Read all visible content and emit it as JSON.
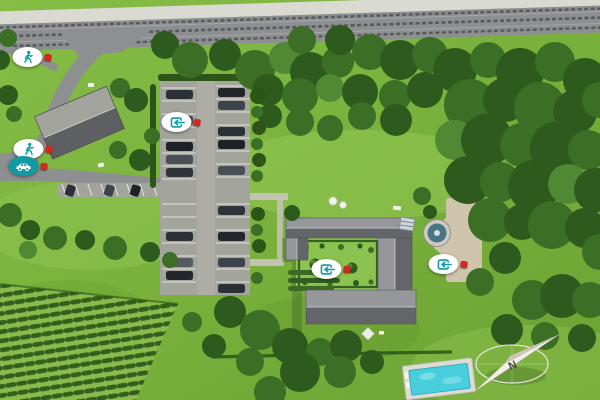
{
  "scene": {
    "type": "3d-aerial-site-plan",
    "compass": {
      "label": "N",
      "pointing": "northeast"
    },
    "colors": {
      "grass": "#79b13c",
      "grass-light": "#93c653",
      "grass-dark": "#5d9129",
      "hedge": "#2c5517",
      "tree-dark": "#2e5a1d",
      "tree-mid": "#3c6e26",
      "tree-light": "#518834",
      "road": "#8d8f90",
      "sidewalk": "#dad9d2",
      "asphalt": "#a3a49c",
      "line": "#e9e9e1",
      "roof-light": "#95979b",
      "roof-dark": "#63656b",
      "path": "#cfc5ac",
      "teal": "#0f9aa4",
      "red": "#cf2a1b",
      "pool": "#49cede",
      "white": "#ffffff"
    },
    "markers": [
      {
        "name": "pedestrian-access-north",
        "kind": "pedestrian",
        "x": 32,
        "y": 57,
        "style": "light",
        "pin": "right"
      },
      {
        "name": "pedestrian-access-west",
        "kind": "pedestrian",
        "x": 33,
        "y": 149,
        "style": "light",
        "pin": "right"
      },
      {
        "name": "vehicle-access-west",
        "kind": "vehicle",
        "x": 28,
        "y": 166,
        "style": "teal",
        "pin": "right"
      },
      {
        "name": "parking-entry-point",
        "kind": "entry",
        "x": 181,
        "y": 122,
        "style": "light",
        "pin": "left"
      },
      {
        "name": "courtyard-entry-point",
        "kind": "entry",
        "x": 331,
        "y": 269,
        "style": "light",
        "pin": "right"
      },
      {
        "name": "east-entry-point",
        "kind": "entry",
        "x": 448,
        "y": 264,
        "style": "light",
        "pin": "left"
      }
    ],
    "features": [
      "highway",
      "sidewalk",
      "access-road",
      "reception-building",
      "parking-lot",
      "parked-cars",
      "main-building-complex",
      "courtyard-garden",
      "fountain",
      "gravel-path",
      "swimming-pool",
      "vineyard",
      "forest",
      "lawn",
      "compass-rose"
    ]
  }
}
